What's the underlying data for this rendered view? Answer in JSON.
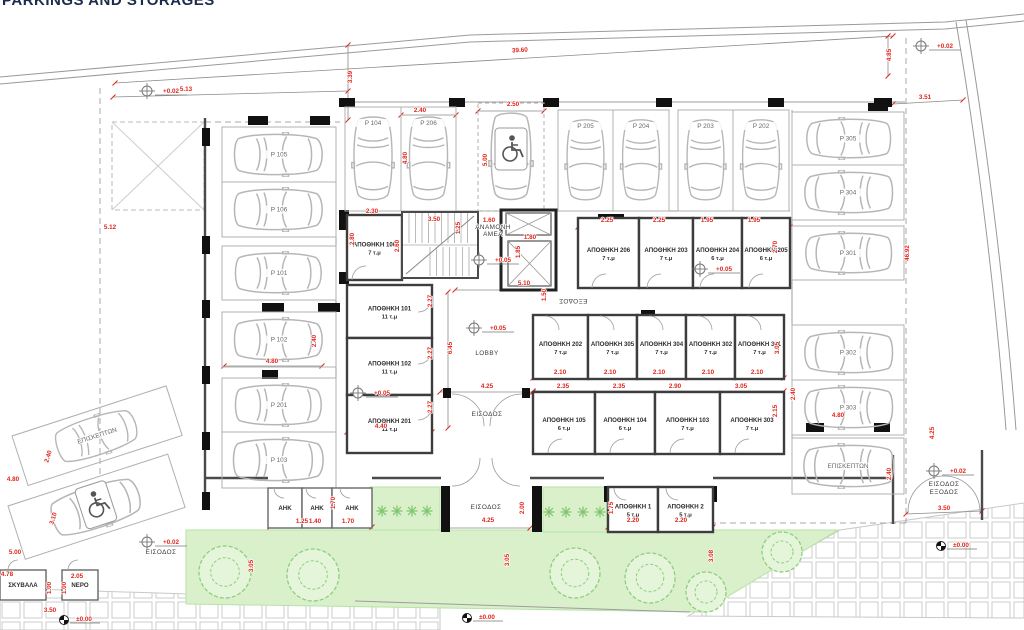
{
  "title": "PARKINGS AND STORAGES",
  "colors": {
    "dimension_red": "#e0251b",
    "wall_dark": "#3d3d3d",
    "car_gray": "#b6b6b6",
    "green_fill": "#d9f0cb",
    "green_stroke": "#8fce7e",
    "tile_stroke": "#cccccc"
  },
  "parking_stalls": [
    {
      "l": "P 105",
      "x": 222,
      "y": 127,
      "w": 114,
      "h": 55,
      "o": "R"
    },
    {
      "l": "P 106",
      "x": 222,
      "y": 182,
      "w": 114,
      "h": 55,
      "o": "R"
    },
    {
      "l": "P 101",
      "x": 222,
      "y": 246,
      "w": 114,
      "h": 54,
      "o": "R"
    },
    {
      "l": "P 102",
      "x": 222,
      "y": 312,
      "w": 114,
      "h": 55,
      "o": "R"
    },
    {
      "l": "P 201",
      "x": 222,
      "y": 378,
      "w": 114,
      "h": 54,
      "o": "R"
    },
    {
      "l": "P 103",
      "x": 222,
      "y": 432,
      "w": 114,
      "h": 56,
      "o": "R"
    },
    {
      "l": "P 104",
      "x": 345,
      "y": 107,
      "w": 56,
      "h": 104,
      "o": "D"
    },
    {
      "l": "P 206",
      "x": 401,
      "y": 107,
      "w": 55,
      "h": 104,
      "o": "D"
    },
    {
      "l": "",
      "x": 478,
      "y": 103,
      "w": 66,
      "h": 108,
      "o": "D",
      "hc": true
    },
    {
      "l": "P 205",
      "x": 558,
      "y": 110,
      "w": 55,
      "h": 101,
      "o": "D"
    },
    {
      "l": "P 204",
      "x": 613,
      "y": 110,
      "w": 56,
      "h": 101,
      "o": "D"
    },
    {
      "l": "P 203",
      "x": 678,
      "y": 110,
      "w": 55,
      "h": 101,
      "o": "D"
    },
    {
      "l": "P 202",
      "x": 733,
      "y": 110,
      "w": 56,
      "h": 101,
      "o": "D"
    },
    {
      "l": "P 305",
      "x": 792,
      "y": 112,
      "w": 112,
      "h": 53,
      "o": "L"
    },
    {
      "l": "P 304",
      "x": 792,
      "y": 165,
      "w": 112,
      "h": 55,
      "o": "L"
    },
    {
      "l": "P 301",
      "x": 792,
      "y": 226,
      "w": 112,
      "h": 54,
      "o": "L"
    },
    {
      "l": "P 302",
      "x": 792,
      "y": 325,
      "w": 112,
      "h": 55,
      "o": "L"
    },
    {
      "l": "P 303",
      "x": 792,
      "y": 380,
      "w": 112,
      "h": 55,
      "o": "L"
    },
    {
      "l": "ΕΠΙΣΚΕΠΤΩΝ",
      "x": 792,
      "y": 438,
      "w": 112,
      "h": 56,
      "o": "L"
    },
    {
      "l": "ΕΠΙΣΚΕΠΤΩΝ",
      "x": 12,
      "y": 436,
      "w": 162,
      "h": 52,
      "o": "R",
      "rot": -18
    },
    {
      "l": "",
      "x": 8,
      "y": 506,
      "w": 168,
      "h": 56,
      "o": "R",
      "rot": -18,
      "hc": true
    }
  ],
  "rooms": [
    {
      "n": "ΑΠΟΘΗΚΗ 106",
      "a": "7 τ.μ",
      "x": 347,
      "y": 215,
      "w": 55,
      "h": 65
    },
    {
      "n": "ΑΠΟΘΗΚΗ 101",
      "a": "11 τ.μ",
      "x": 347,
      "y": 285,
      "w": 85,
      "h": 53
    },
    {
      "n": "ΑΠΟΘΗΚΗ 102",
      "a": "11 τ.μ",
      "x": 347,
      "y": 338,
      "w": 85,
      "h": 57
    },
    {
      "n": "ΑΠΟΘΗΚΗ 201",
      "a": "11 τ.μ",
      "x": 347,
      "y": 395,
      "w": 85,
      "h": 58
    },
    {
      "n": "ΑΠΟΘΗΚΗ 206",
      "a": "7 τ.μ",
      "x": 578,
      "y": 218,
      "w": 61,
      "h": 70
    },
    {
      "n": "ΑΠΟΘΗΚΗ 203",
      "a": "7 τ.μ",
      "x": 639,
      "y": 218,
      "w": 54,
      "h": 70
    },
    {
      "n": "ΑΠΟΘΗΚΗ 204",
      "a": "6 τ.μ",
      "x": 693,
      "y": 218,
      "w": 49,
      "h": 70
    },
    {
      "n": "ΑΠΟΘΗΚΗ 205",
      "a": "6 τ.μ",
      "x": 742,
      "y": 218,
      "w": 48,
      "h": 70
    },
    {
      "n": "ΑΠΟΘΗΚΗ 202",
      "a": "7 τ.μ",
      "x": 533,
      "y": 315,
      "w": 55,
      "h": 64
    },
    {
      "n": "ΑΠΟΘΗΚΗ 305",
      "a": "7 τ.μ",
      "x": 588,
      "y": 315,
      "w": 49,
      "h": 64
    },
    {
      "n": "ΑΠΟΘΗΚΗ 304",
      "a": "7 τ.μ",
      "x": 637,
      "y": 315,
      "w": 49,
      "h": 64
    },
    {
      "n": "ΑΠΟΘΗΚΗ 302",
      "a": "7 τ.μ",
      "x": 686,
      "y": 315,
      "w": 49,
      "h": 64
    },
    {
      "n": "ΑΠΟΘΗΚΗ 301",
      "a": "7 τ.μ",
      "x": 735,
      "y": 315,
      "w": 49,
      "h": 64
    },
    {
      "n": "ΑΠΟΘΗΚΗ 105",
      "a": "6 τ.μ",
      "x": 533,
      "y": 392,
      "w": 62,
      "h": 62
    },
    {
      "n": "ΑΠΟΘΗΚΗ 104",
      "a": "6 τ.μ",
      "x": 595,
      "y": 392,
      "w": 60,
      "h": 62
    },
    {
      "n": "ΑΠΟΘΗΚΗ 103",
      "a": "7 τ.μ",
      "x": 655,
      "y": 392,
      "w": 65,
      "h": 62
    },
    {
      "n": "ΑΠΟΘΗΚΗ 303",
      "a": "7 τ.μ",
      "x": 720,
      "y": 392,
      "w": 64,
      "h": 62
    },
    {
      "n": "ΑΠΟΘΗΚΗ 1",
      "a": "5 τ.μ",
      "x": 608,
      "y": 487,
      "w": 50,
      "h": 45
    },
    {
      "n": "ΑΠΟΘΗΚΗ 2",
      "a": "5 τ.μ",
      "x": 658,
      "y": 487,
      "w": 55,
      "h": 45
    },
    {
      "n": "ΑΗΚ",
      "a": "",
      "x": 268,
      "y": 488,
      "w": 34,
      "h": 40
    },
    {
      "n": "ΑΗΚ",
      "a": "",
      "x": 302,
      "y": 488,
      "w": 30,
      "h": 40
    },
    {
      "n": "ΑΗΚ",
      "a": "",
      "x": 332,
      "y": 488,
      "w": 40,
      "h": 40
    },
    {
      "n": "ΣΚΥΒΑΛΑ",
      "a": "",
      "x": 0,
      "y": 570,
      "w": 46,
      "h": 30
    },
    {
      "n": "ΝΕΡΟ",
      "a": "",
      "x": 62,
      "y": 570,
      "w": 36,
      "h": 30
    }
  ],
  "labels": [
    {
      "t": "LOBBY",
      "x": 487,
      "y": 355,
      "s": 7.5
    },
    {
      "t": "ΕΙΣΟΔΟΣ",
      "x": 487,
      "y": 416
    },
    {
      "t": "ΕΞΟΔΟΣ",
      "x": 573,
      "y": 299,
      "r": 180
    },
    {
      "t": "ΑΝΑΜΟΝΗ",
      "x": 493,
      "y": 229,
      "s": 5
    },
    {
      "t": "ΑΜΕΑ",
      "x": 493,
      "y": 236,
      "s": 5
    },
    {
      "t": "ΕΙΣΟΔΟΣ",
      "x": 486,
      "y": 509
    },
    {
      "t": "ΕΙΣΟΔΟΣ",
      "x": 944,
      "y": 486
    },
    {
      "t": "ΕΞΟΔΟΣ",
      "x": 944,
      "y": 494
    },
    {
      "t": "ΕΙΣΟΔΟΣ",
      "x": 161,
      "y": 554
    }
  ],
  "dims": [
    {
      "t": "39.60",
      "x": 520,
      "y": 52,
      "r": -3.5
    },
    {
      "t": "3.39",
      "x": 352,
      "y": 77,
      "r": -90
    },
    {
      "t": "5.13",
      "x": 186,
      "y": 91
    },
    {
      "t": "5.12",
      "x": 110,
      "y": 229
    },
    {
      "t": "3.51",
      "x": 925,
      "y": 99
    },
    {
      "t": "4.85",
      "x": 891,
      "y": 55,
      "r": -90
    },
    {
      "t": "46.92",
      "x": 909,
      "y": 253,
      "r": -90
    },
    {
      "t": "2.30",
      "x": 372,
      "y": 213
    },
    {
      "t": "2.80",
      "x": 354,
      "y": 239,
      "r": -90
    },
    {
      "t": "3.50",
      "x": 434,
      "y": 221
    },
    {
      "t": "2.60",
      "x": 399,
      "y": 246,
      "r": -90
    },
    {
      "t": "1.25",
      "x": 460,
      "y": 228,
      "r": -90
    },
    {
      "t": "1.60",
      "x": 489,
      "y": 222
    },
    {
      "t": "1.80",
      "x": 530,
      "y": 239
    },
    {
      "t": "1.85",
      "x": 520,
      "y": 252,
      "r": -90
    },
    {
      "t": "5.10",
      "x": 524,
      "y": 285
    },
    {
      "t": "1.50",
      "x": 546,
      "y": 295,
      "r": -90
    },
    {
      "t": "2.27",
      "x": 432,
      "y": 301,
      "r": -90
    },
    {
      "t": "2.27",
      "x": 432,
      "y": 353,
      "r": -90
    },
    {
      "t": "2.27",
      "x": 432,
      "y": 407,
      "r": -90
    },
    {
      "t": "6.45",
      "x": 452,
      "y": 348,
      "r": -90
    },
    {
      "t": "4.25",
      "x": 487,
      "y": 388
    },
    {
      "t": "4.40",
      "x": 381,
      "y": 428
    },
    {
      "t": "2.40",
      "x": 316,
      "y": 341,
      "r": -90
    },
    {
      "t": "4.80",
      "x": 272,
      "y": 363
    },
    {
      "t": "2.40",
      "x": 420,
      "y": 112
    },
    {
      "t": "4.80",
      "x": 407,
      "y": 158,
      "r": -90
    },
    {
      "t": "2.50",
      "x": 513,
      "y": 106
    },
    {
      "t": "5.00",
      "x": 487,
      "y": 160,
      "r": -90
    },
    {
      "t": "2.25",
      "x": 607,
      "y": 222
    },
    {
      "t": "2.25",
      "x": 659,
      "y": 222
    },
    {
      "t": "1.95",
      "x": 707,
      "y": 222
    },
    {
      "t": "1.95",
      "x": 754,
      "y": 222
    },
    {
      "t": "2.70",
      "x": 777,
      "y": 247,
      "r": -90
    },
    {
      "t": "2.10",
      "x": 560,
      "y": 374
    },
    {
      "t": "2.10",
      "x": 610,
      "y": 374
    },
    {
      "t": "2.10",
      "x": 659,
      "y": 374
    },
    {
      "t": "2.10",
      "x": 708,
      "y": 374
    },
    {
      "t": "2.10",
      "x": 757,
      "y": 374
    },
    {
      "t": "3.05",
      "x": 779,
      "y": 348,
      "r": -90
    },
    {
      "t": "2.35",
      "x": 563,
      "y": 388
    },
    {
      "t": "2.35",
      "x": 619,
      "y": 388
    },
    {
      "t": "2.90",
      "x": 675,
      "y": 388
    },
    {
      "t": "3.05",
      "x": 741,
      "y": 388
    },
    {
      "t": "2.15",
      "x": 777,
      "y": 411,
      "r": -90
    },
    {
      "t": "2.40",
      "x": 795,
      "y": 394,
      "r": -90
    },
    {
      "t": "4.80",
      "x": 838,
      "y": 417
    },
    {
      "t": "2.40",
      "x": 891,
      "y": 474,
      "r": -90
    },
    {
      "t": "4.25",
      "x": 934,
      "y": 433,
      "r": -90
    },
    {
      "t": "1.25",
      "x": 302,
      "y": 523
    },
    {
      "t": "1.40",
      "x": 315,
      "y": 523
    },
    {
      "t": "1.70",
      "x": 348,
      "y": 523
    },
    {
      "t": "1.70",
      "x": 335,
      "y": 503,
      "r": -90
    },
    {
      "t": "4.25",
      "x": 488,
      "y": 522
    },
    {
      "t": "2.00",
      "x": 524,
      "y": 508,
      "r": -90
    },
    {
      "t": "2.20",
      "x": 633,
      "y": 522
    },
    {
      "t": "2.20",
      "x": 681,
      "y": 522
    },
    {
      "t": "1.75",
      "x": 613,
      "y": 508,
      "r": -90
    },
    {
      "t": "3.05",
      "x": 253,
      "y": 566,
      "r": -90
    },
    {
      "t": "3.05",
      "x": 509,
      "y": 560,
      "r": -90
    },
    {
      "t": "3.08",
      "x": 713,
      "y": 556,
      "r": -90
    },
    {
      "t": "3.50",
      "x": 944,
      "y": 510
    },
    {
      "t": "4.80",
      "x": 13,
      "y": 481
    },
    {
      "t": "2.40",
      "x": 50,
      "y": 457,
      "r": -72
    },
    {
      "t": "3.10",
      "x": 55,
      "y": 519,
      "r": -72
    },
    {
      "t": "5.00",
      "x": 15,
      "y": 554
    },
    {
      "t": "4.78",
      "x": 7,
      "y": 576
    },
    {
      "t": "2.05",
      "x": 77,
      "y": 578
    },
    {
      "t": "1.00",
      "x": 51,
      "y": 588,
      "r": -90
    },
    {
      "t": "1.00",
      "x": 66,
      "y": 588,
      "r": -90
    },
    {
      "t": "3.50",
      "x": 50,
      "y": 612
    }
  ],
  "elevation_markers": [
    {
      "t": "+0.02",
      "x": 147,
      "y": 91
    },
    {
      "t": "+0.02",
      "x": 921,
      "y": 46
    },
    {
      "t": "+0.05",
      "x": 479,
      "y": 260
    },
    {
      "t": "+0.05",
      "x": 700,
      "y": 269
    },
    {
      "t": "+0.05",
      "x": 474,
      "y": 328
    },
    {
      "t": "+0.05",
      "x": 358,
      "y": 393
    },
    {
      "t": "+0.02",
      "x": 934,
      "y": 471
    },
    {
      "t": "+0.02",
      "x": 147,
      "y": 542
    }
  ],
  "benchmarks": [
    {
      "t": "±0.00",
      "x": 64,
      "y": 620
    },
    {
      "t": "±0.00",
      "x": 467,
      "y": 618
    },
    {
      "t": "±0.00",
      "x": 941,
      "y": 546
    }
  ]
}
